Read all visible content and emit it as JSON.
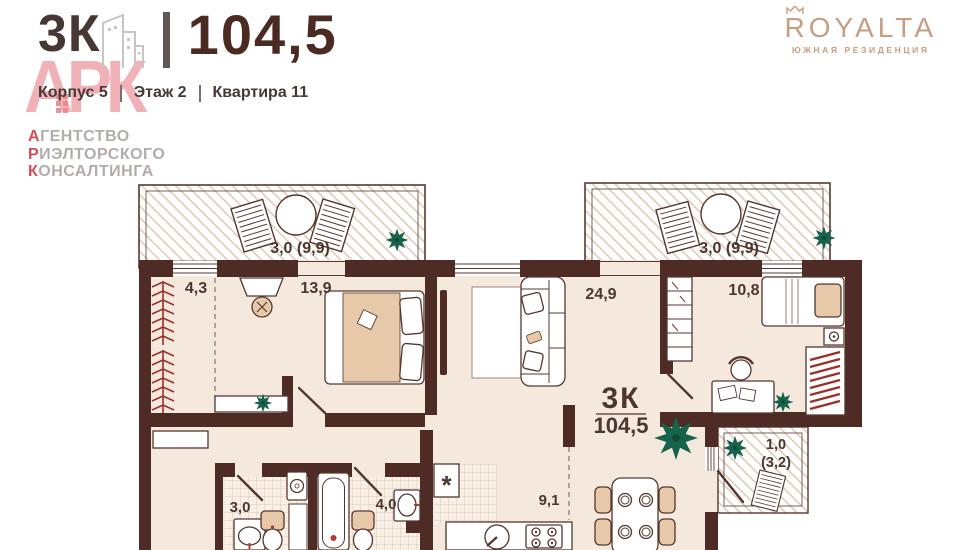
{
  "header": {
    "rooms": "3К",
    "area": "104,5",
    "building": "Корпус 5",
    "floor": "Этаж 2",
    "apartment": "Квартира 11"
  },
  "watermark": {
    "letters": "АРК",
    "lines": [
      {
        "first": "А",
        "rest": "ГЕНТСТВО"
      },
      {
        "first": "Р",
        "rest": "ИЭЛТОРСКОГО"
      },
      {
        "first": "К",
        "rest": "ОНСАЛТИНГА"
      }
    ]
  },
  "brand": {
    "name": "ROYALTA",
    "subtitle": "ЮЖНАЯ РЕЗИДЕНЦИЯ"
  },
  "plan": {
    "summary": {
      "rooms": "3К",
      "area": "104,5"
    },
    "labels": {
      "balcony_left": "3,0 (9,9)",
      "balcony_right": "3,0 (9,9)",
      "wardrobe": "4,3",
      "bedroom_main": "13,9",
      "living": "24,9",
      "bedroom_second": "10,8",
      "bathroom_small": "3,0",
      "bathroom_large": "4,0",
      "kitchen": "9,1",
      "loggia": "1,0",
      "loggia_total": "(3,2)",
      "fridge_mark": "*"
    },
    "colors": {
      "wall": "#4e2b25",
      "floor": "#f5e9de",
      "furniture_tan": "#e7c8a8",
      "accent_red": "#9c2f2b",
      "plant_green": "#17624a",
      "brand_tan": "#c69e81",
      "logo_pink": "#efa2a8",
      "label_brown": "#4d362e"
    }
  }
}
